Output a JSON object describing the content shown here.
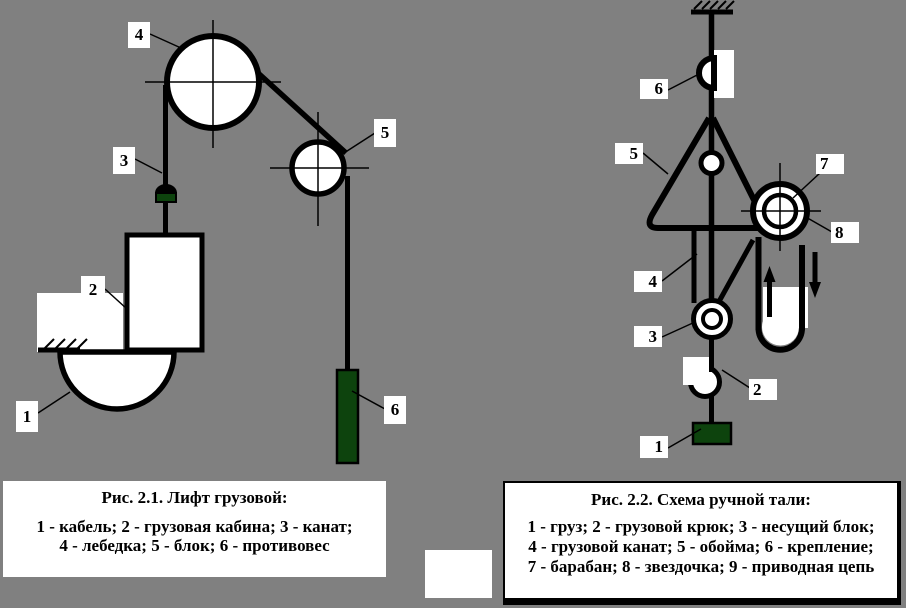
{
  "colors": {
    "background": "#808080",
    "line_black": "#000000",
    "fill_white": "#ffffff",
    "load_green": "#0d430d"
  },
  "figure_left": {
    "name": "Лифт грузовой",
    "labels": [
      "1",
      "2",
      "3",
      "4",
      "5",
      "6"
    ],
    "caption": {
      "title": "Рис. 2.1. Лифт грузовой:",
      "line1": "1 - кабель; 2 - грузовая кабина; 3 - канат;",
      "line2": "4 - лебедка; 5 - блок; 6 - противовес"
    }
  },
  "figure_right": {
    "name": "Схема ручной тали",
    "labels": [
      "1",
      "2",
      "3",
      "4",
      "5",
      "6",
      "7",
      "8"
    ],
    "caption": {
      "title": "Рис. 2.2. Схема ручной тали:",
      "line1": "1 - груз; 2 - грузовой крюк; 3 - несущий блок;",
      "line2": "4 - грузовой канат; 5 - обойма; 6 - крепление;",
      "line3": "7 - барабан; 8 - звездочка; 9 - приводная цепь"
    }
  }
}
